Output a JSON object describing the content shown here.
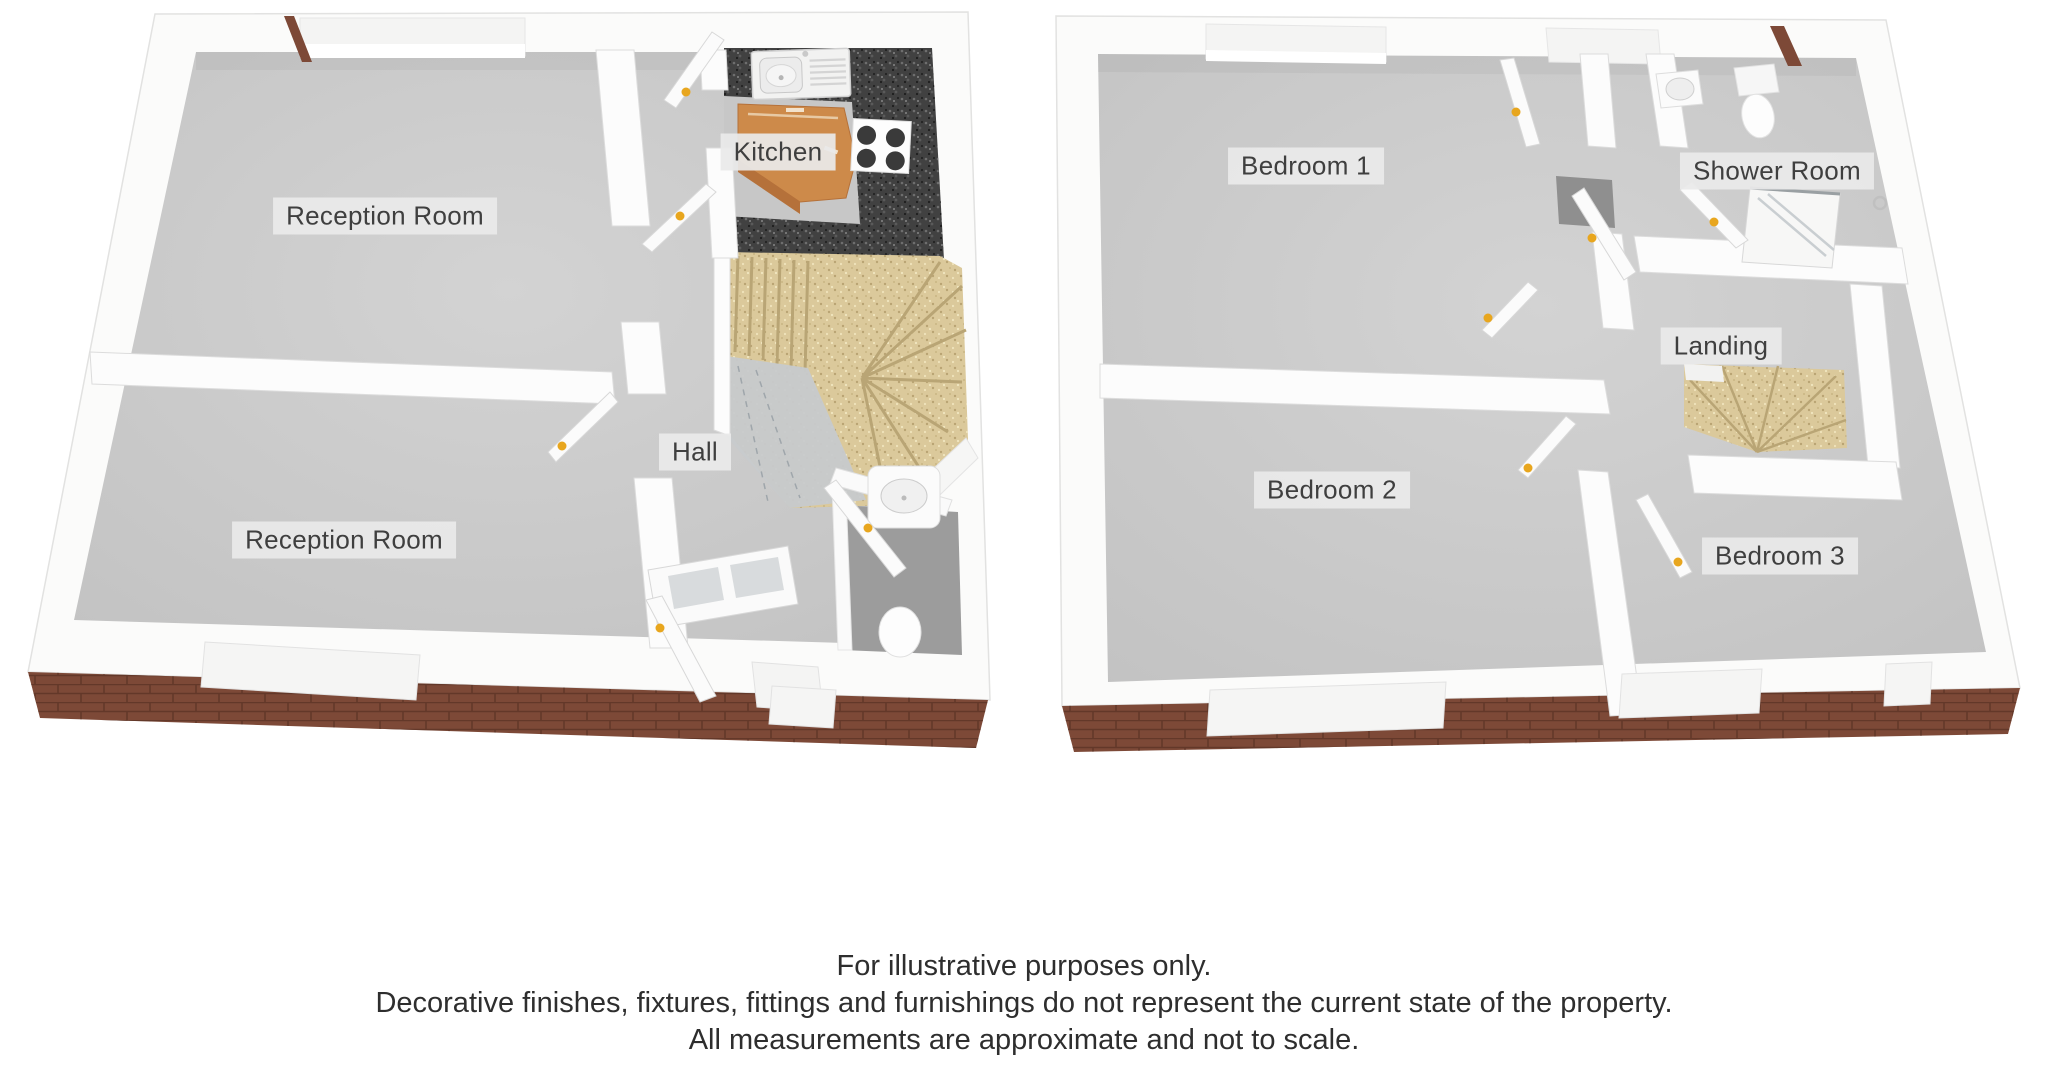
{
  "image": {
    "width": 2048,
    "height": 1065,
    "background": "#ffffff"
  },
  "floorplan": {
    "ground_floor": {
      "rooms": [
        {
          "id": "reception_room_1",
          "label": "Reception Room"
        },
        {
          "id": "kitchen",
          "label": "Kitchen"
        },
        {
          "id": "hall",
          "label": "Hall"
        },
        {
          "id": "reception_room_2",
          "label": "Reception Room"
        }
      ],
      "features": [
        "kitchen-sink",
        "kitchen-counter",
        "hob",
        "winder-staircase",
        "wc-toilet",
        "wc-basin",
        "front-door",
        "porch-door"
      ]
    },
    "first_floor": {
      "rooms": [
        {
          "id": "bedroom_1",
          "label": "Bedroom 1"
        },
        {
          "id": "shower_room",
          "label": "Shower Room"
        },
        {
          "id": "landing",
          "label": "Landing"
        },
        {
          "id": "bedroom_2",
          "label": "Bedroom 2"
        },
        {
          "id": "bedroom_3",
          "label": "Bedroom 3"
        }
      ],
      "features": [
        "shower-tray",
        "toilet",
        "basin",
        "stairwell"
      ]
    }
  },
  "labels": {
    "reception_room_1": "Reception Room",
    "kitchen": "Kitchen",
    "hall": "Hall",
    "reception_room_2": "Reception Room",
    "bedroom_1": "Bedroom 1",
    "shower_room": "Shower Room",
    "landing": "Landing",
    "bedroom_2": "Bedroom 2",
    "bedroom_3": "Bedroom 3"
  },
  "disclaimer": {
    "line1": "For illustrative purposes only.",
    "line2": "Decorative finishes, fixtures, fittings and furnishings do not represent the current state of the property.",
    "line3": "All measurements are approximate and not to scale."
  },
  "colors": {
    "wall": "#fbfbfa",
    "interior_wall": "#fcfcfc",
    "floor": "#c7c7c7",
    "floor_light": "#d2d2d2",
    "brick": "#7d4937",
    "brick_mortar": "#5e3527",
    "carpet": "#dbc99b",
    "carpet_edge": "#b9a575",
    "granite": "#414141",
    "wood_counter": "#cd8a4a",
    "wood_counter_front": "#b5713a",
    "door_handle": "#e8a61e",
    "wc_floor": "#9c9c9c",
    "shadow_recess": "#8f8f8f",
    "glass": "#d8dbdd",
    "label_background": "#e9e9e9",
    "label_text": "#3f3f3f",
    "disclaimer_text": "#2e2e2e"
  }
}
